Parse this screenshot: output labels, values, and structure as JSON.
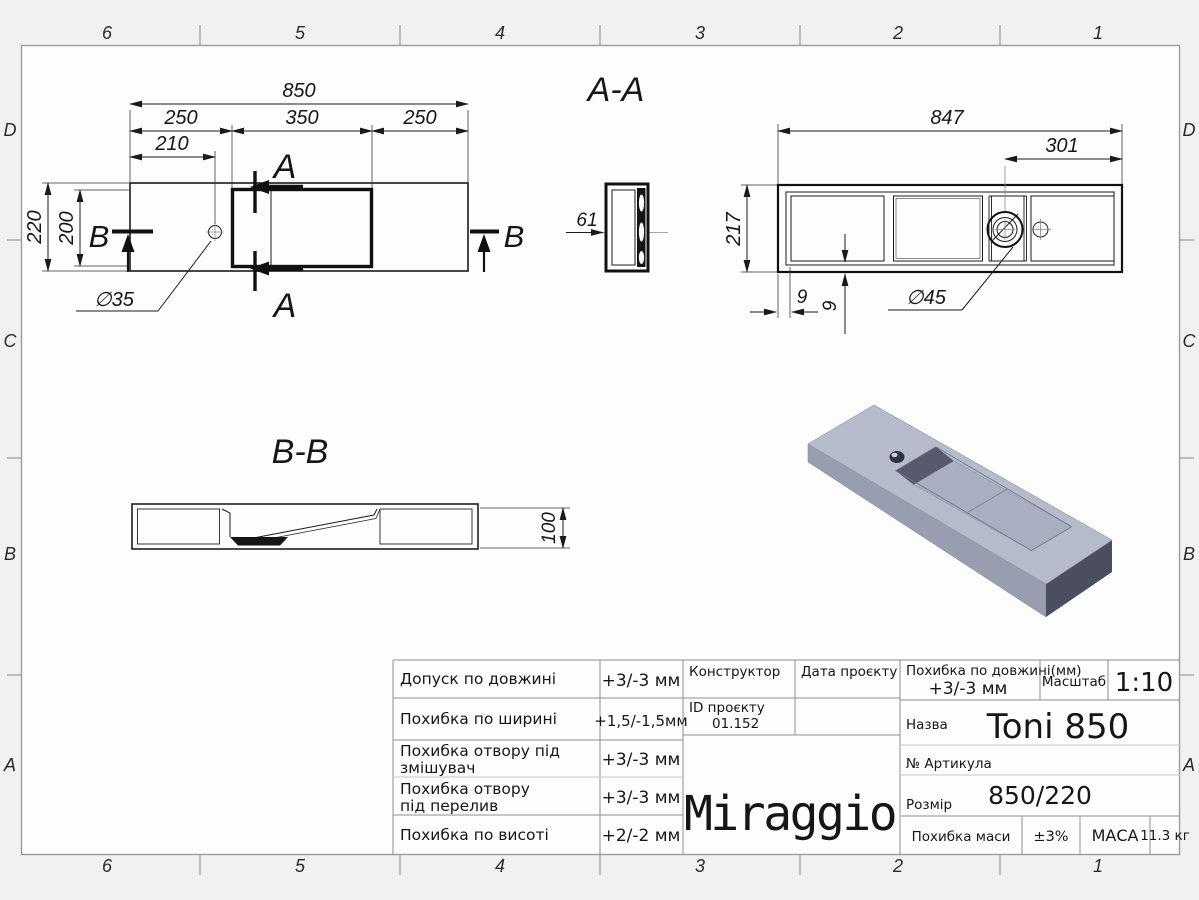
{
  "frame": {
    "cols": [
      "6",
      "5",
      "4",
      "3",
      "2",
      "1"
    ],
    "rows": [
      "D",
      "C",
      "B",
      "A"
    ]
  },
  "plan_view": {
    "section_letter": "A",
    "cut_letter": "B",
    "dim_overall": "850",
    "dim_left": "250",
    "dim_middle": "350",
    "dim_right": "250",
    "dim_hole_offset": "210",
    "dim_depth_outer": "220",
    "dim_depth_inner": "200",
    "dim_hole_diameter": "∅35"
  },
  "section_aa": {
    "title": "A-A",
    "dim_thickness": "61"
  },
  "view_bottom": {
    "dim_overall": "847",
    "dim_drain_offset": "301",
    "dim_width": "217",
    "dim_wall": "9",
    "dim_bottom_wall": "9",
    "dim_drain_diameter": "∅45"
  },
  "section_bb": {
    "title": "B-B",
    "dim_height": "100"
  },
  "title_block": {
    "rows": [
      {
        "label": "Допуск по довжині",
        "label2": "",
        "value": "+3/-3 мм"
      },
      {
        "label": "Похибка по ширині",
        "label2": "",
        "value": "+1,5/-1,5мм"
      },
      {
        "label": "Похибка отвору під",
        "label2": "змішувач",
        "value": "+3/-3 мм"
      },
      {
        "label": "Похибка отвору",
        "label2": "під перелив",
        "value": "+3/-3 мм"
      },
      {
        "label": "Похибка по висоті",
        "label2": "",
        "value": "+2/-2 мм"
      }
    ],
    "constructor_label": "Конструктор",
    "project_date_label": "Дата проєкту",
    "project_id_label": "ID проєкту",
    "project_id_value": "01.152",
    "logo": "Miraggio",
    "length_tol_label": "Похибка по довжині(мм)",
    "length_tol_value": "+3/-3 мм",
    "scale_label": "Масштаб",
    "scale_value": "1:10",
    "name_label": "Назва",
    "name_value": "Toni 850",
    "article_label": "№ Артикула",
    "size_label": "Розмір",
    "size_value": "850/220",
    "mass_tol_label": "Похибка маси",
    "mass_tol_value": "±3%",
    "mass_label": "МАСА",
    "mass_value": "11.3 кг"
  },
  "colors": {
    "drawing_line": "#1a1a1a",
    "render_top": "#b5bbca",
    "render_front": "#989eb0",
    "render_end": "#4a4e5e",
    "render_basin_wall": "#565a6c",
    "render_floor": "#a9afc1"
  }
}
